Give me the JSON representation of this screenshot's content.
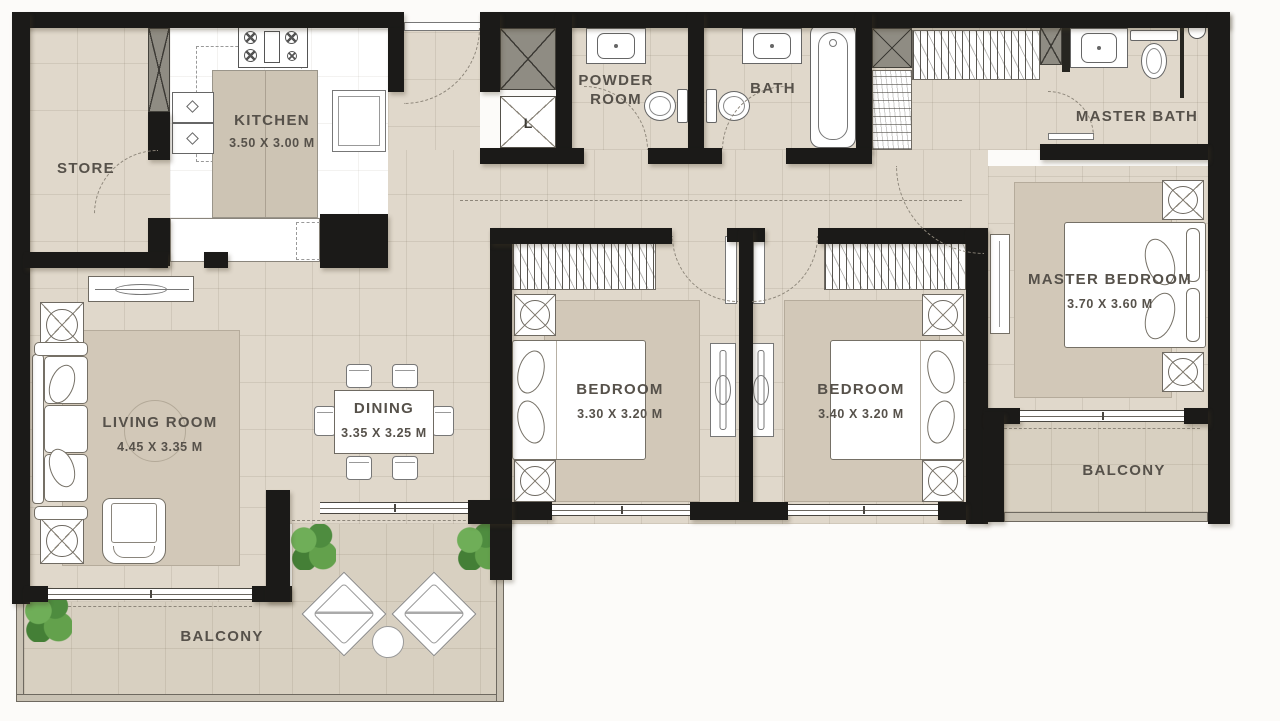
{
  "rooms": {
    "store": {
      "label": "STORE"
    },
    "kitchen": {
      "label": "KITCHEN",
      "dims": "3.50 X 3.00 M"
    },
    "powder_room": {
      "label": "POWDER ROOM"
    },
    "bath": {
      "label": "BATH"
    },
    "master_bath": {
      "label": "MASTER BATH"
    },
    "living_room": {
      "label": "LIVING ROOM",
      "dims": "4.45 X 3.35 M"
    },
    "dining": {
      "label": "DINING",
      "dims": "3.35 X 3.25 M"
    },
    "bedroom_1": {
      "label": "BEDROOM",
      "dims": "3.30 X 3.20 M"
    },
    "bedroom_2": {
      "label": "BEDROOM",
      "dims": "3.40 X 3.20 M"
    },
    "master_bedroom": {
      "label": "MASTER BEDROOM",
      "dims": "3.70 X 3.60 M"
    },
    "balcony_main": {
      "label": "BALCONY"
    },
    "balcony_master": {
      "label": "BALCONY"
    }
  },
  "annotations": {
    "lift_label": "L"
  },
  "colors": {
    "wall": "#1b1a18",
    "floor": "#e0d8cb",
    "balcony_floor": "#d8d0c1",
    "rug": "#d2c8b8",
    "kitchen_floor": "#ffffff",
    "shaft": "#8f8c83",
    "text": "#56514a",
    "plant": "#5f9a4e",
    "fixture_line": "#6f6a62"
  }
}
